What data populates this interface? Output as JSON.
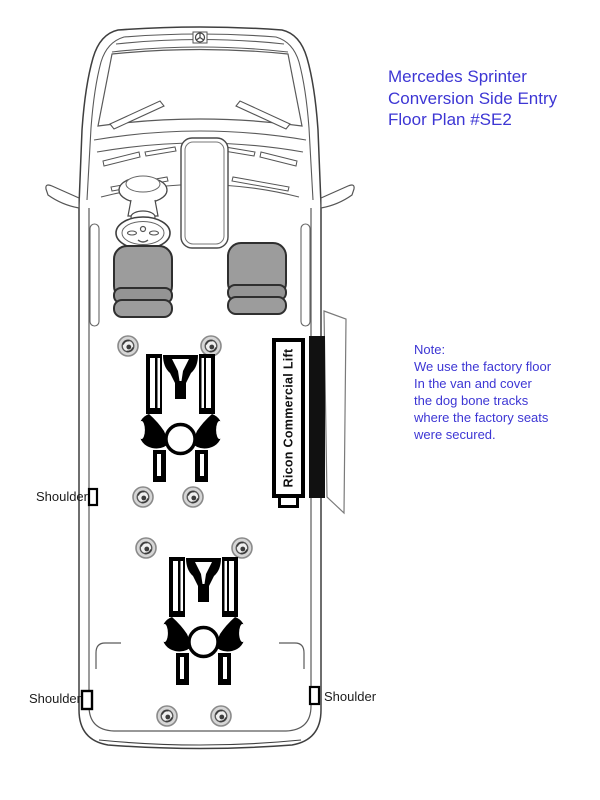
{
  "title": {
    "lines": [
      "Mercedes Sprinter",
      "Conversion Side Entry",
      "Floor Plan #SE2"
    ],
    "color": "#3d36d4"
  },
  "note": {
    "lines": [
      "Note:",
      "We use the factory floor",
      "In the van and cover",
      "the dog bone tracks",
      "where the factory seats",
      "were secured."
    ],
    "color": "#3d36d4"
  },
  "van": {
    "view": "top-down floor plan",
    "lift_label": "Ricon Commercial Lift",
    "shoulder_labels": {
      "left_upper": "Shoulder",
      "left_lower": "Shoulder",
      "right": "Shoulder"
    },
    "seat_count": 2,
    "wheelchair_positions": 2,
    "floor_anchor_points": 8,
    "colors": {
      "seat_gray": "#9c9c9c",
      "door_opening_bar": "#111111",
      "body_outline": "#3f3f3f",
      "anchor_fill": "#d6d6d6",
      "text_blue": "#3d36d4"
    }
  }
}
